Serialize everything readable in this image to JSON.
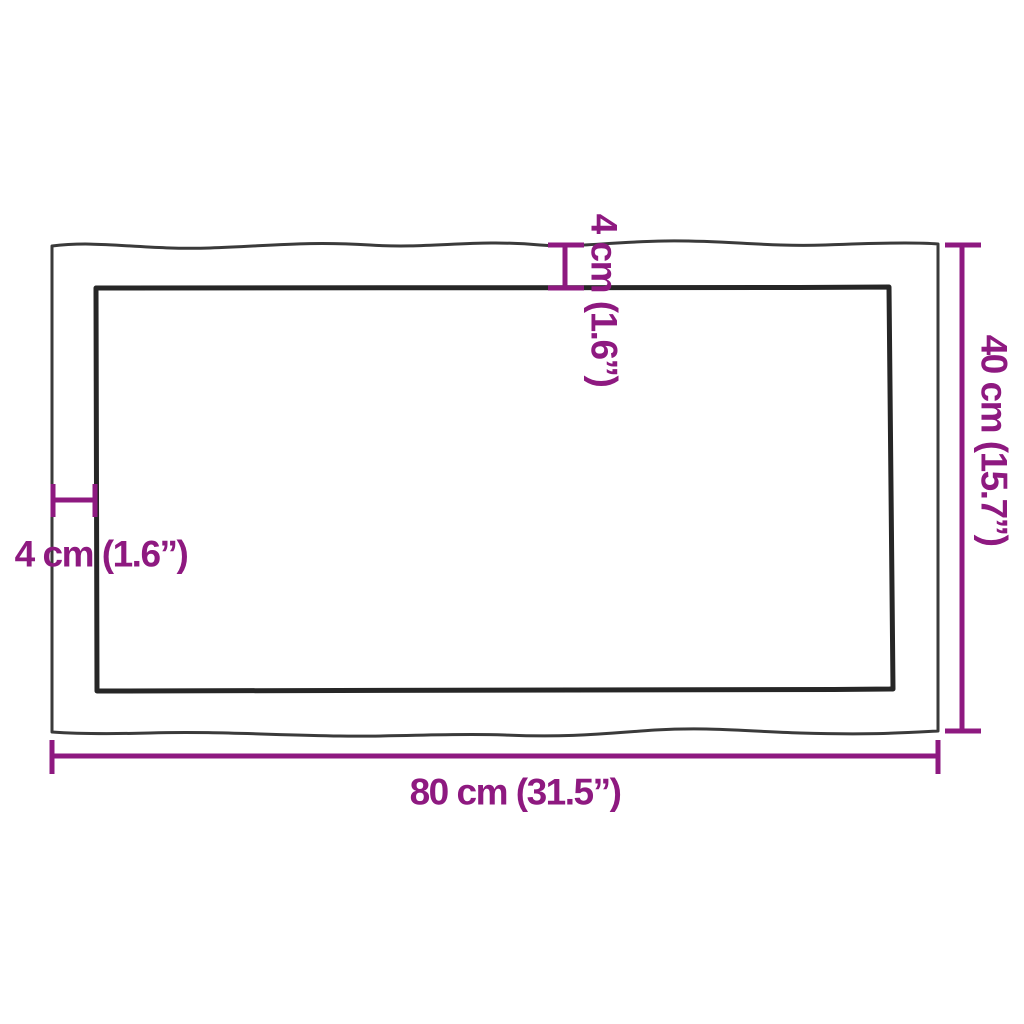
{
  "diagram": {
    "colors": {
      "dimension_accent": "#8E1980",
      "outer_outline": "#3a3a3a",
      "inner_outline": "#262626",
      "background": "#ffffff"
    },
    "labels": {
      "width": "80 cm (31.5”)",
      "height": "40 cm (15.7”)",
      "edge_thickness_top": "4 cm (1.6”)",
      "edge_thickness_left": "4 cm (1.6”)"
    }
  }
}
